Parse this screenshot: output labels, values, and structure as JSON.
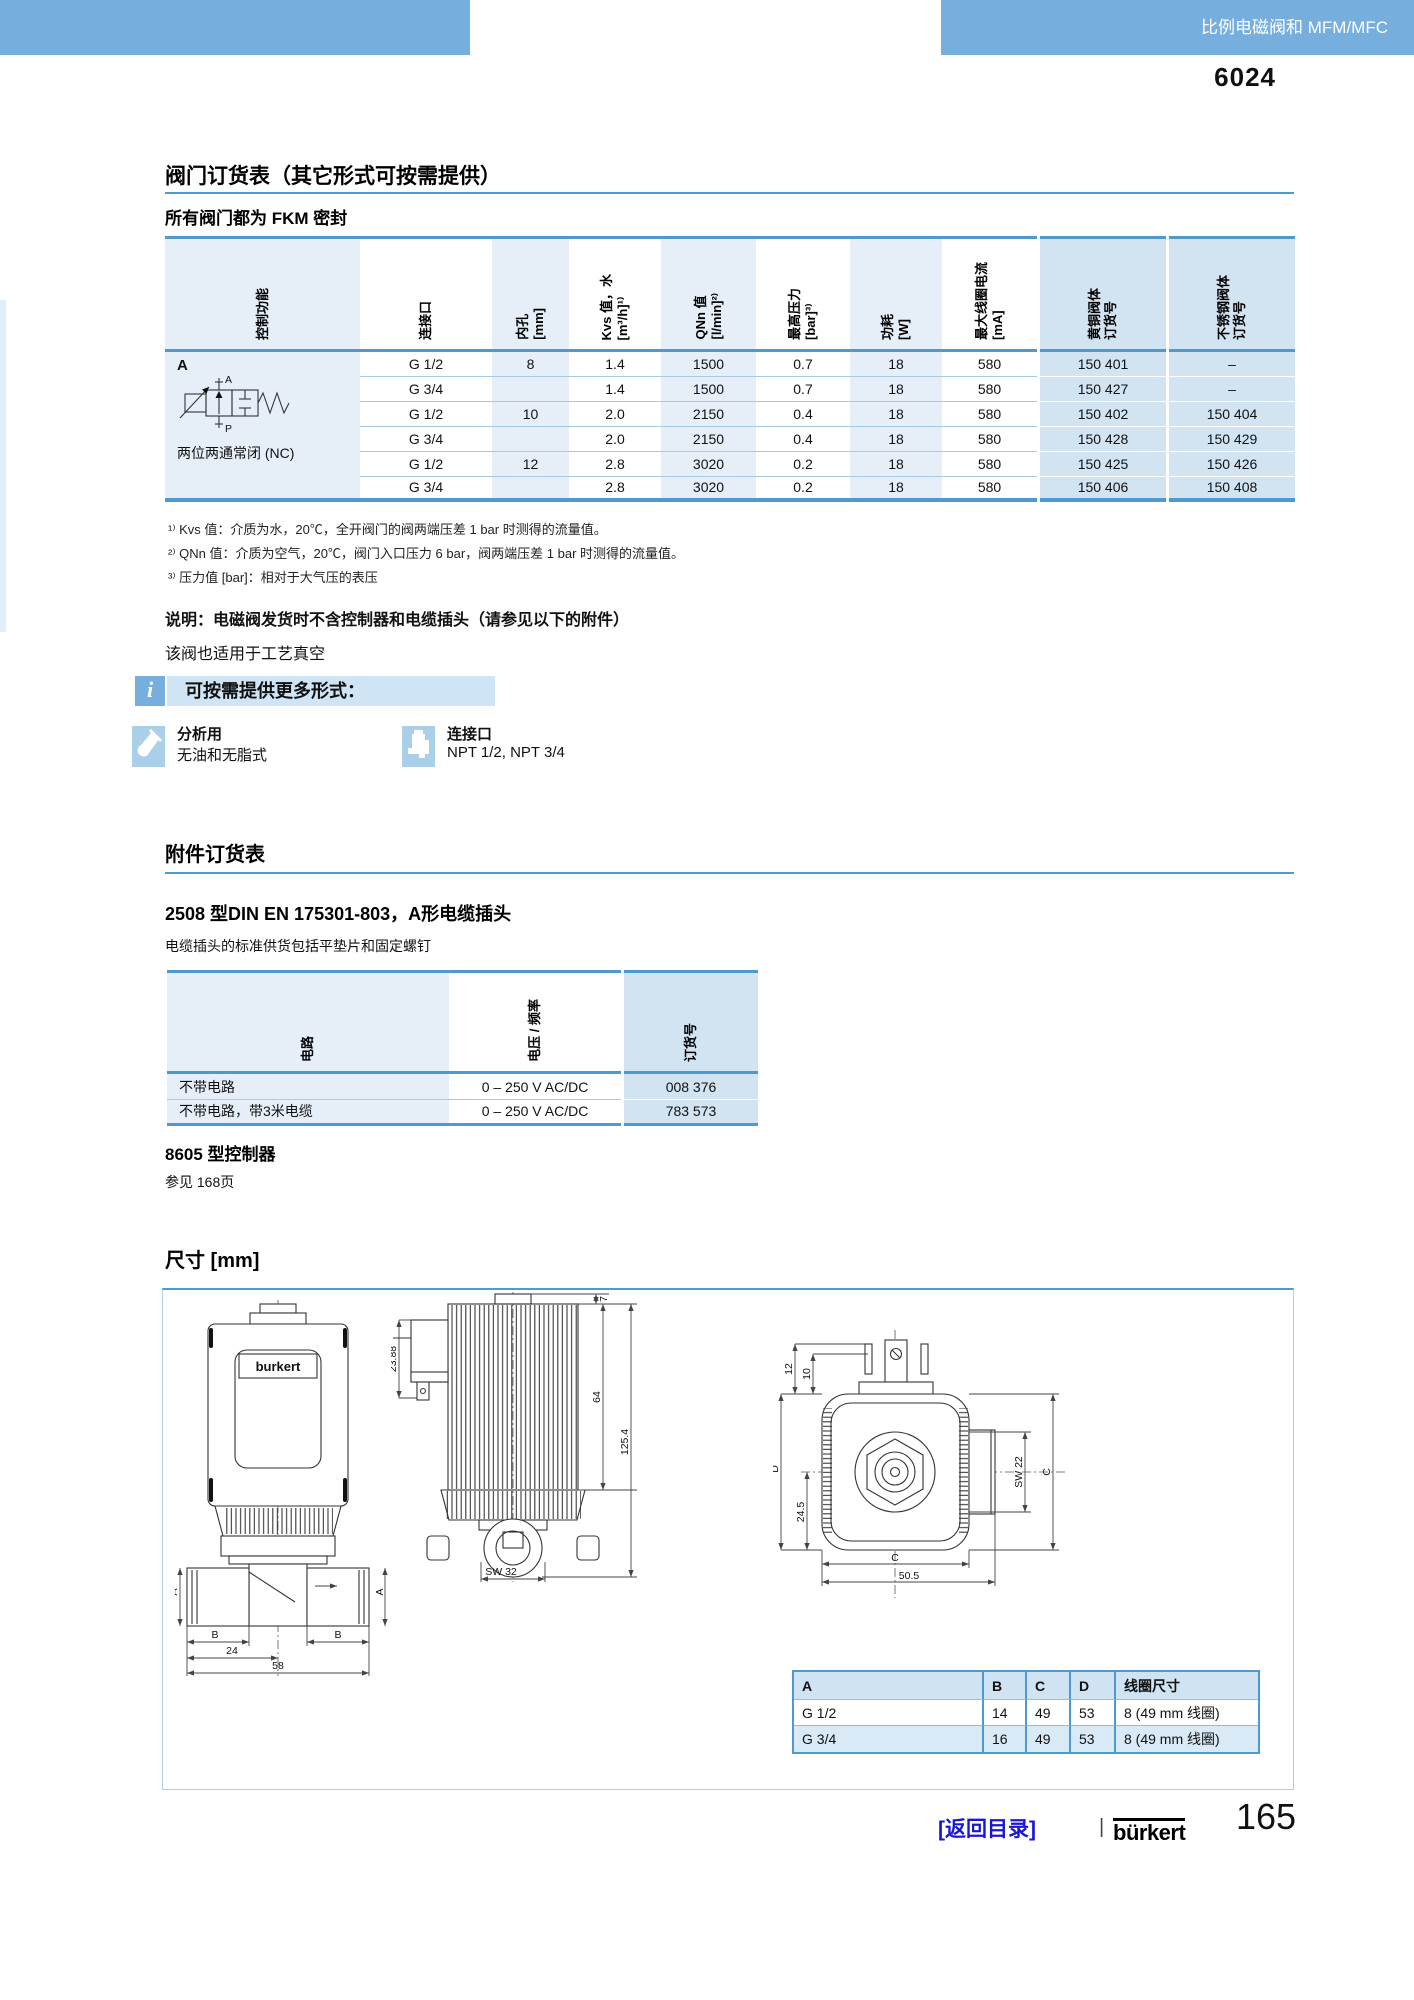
{
  "header": {
    "banner_label": "比例电磁阀和 MFM/MFC",
    "type_number": "6024"
  },
  "valve_section": {
    "title": "阀门订货表（其它形式可按需提供）",
    "subtitle": "所有阀门都为 FKM 密封",
    "table": {
      "headers": [
        "控制功能",
        "连接口",
        "内孔\n[mm]",
        "Kvs 值，水\n[m³/h]¹⁾",
        "QNn 值\n[l/min]²⁾",
        "最高压力\n[bar]³⁾",
        "功耗\n[W]",
        "最大线圈电流\n[mA]",
        "黄铜阀体\n订货号",
        "不锈钢阀体\n订货号"
      ],
      "control": {
        "code": "A",
        "port_top": "A",
        "port_bottom": "P",
        "caption": "两位两通常闭 (NC)"
      },
      "rows": [
        [
          "G 1/2",
          "8",
          "1.4",
          "1500",
          "0.7",
          "18",
          "580",
          "150 401",
          "–"
        ],
        [
          "G 3/4",
          "",
          "1.4",
          "1500",
          "0.7",
          "18",
          "580",
          "150 427",
          "–"
        ],
        [
          "G 1/2",
          "10",
          "2.0",
          "2150",
          "0.4",
          "18",
          "580",
          "150 402",
          "150 404"
        ],
        [
          "G 3/4",
          "",
          "2.0",
          "2150",
          "0.4",
          "18",
          "580",
          "150 428",
          "150 429"
        ],
        [
          "G 1/2",
          "12",
          "2.8",
          "3020",
          "0.2",
          "18",
          "580",
          "150 425",
          "150 426"
        ],
        [
          "G 3/4",
          "",
          "2.8",
          "3020",
          "0.2",
          "18",
          "580",
          "150 406",
          "150 408"
        ]
      ]
    },
    "footnotes": [
      "¹⁾ Kvs 值：介质为水，20℃，全开阀门的阀两端压差 1 bar 时测得的流量值。",
      "²⁾ QNn 值：介质为空气，20℃，阀门入口压力 6 bar，阀两端压差 1 bar 时测得的流量值。",
      "³⁾ 压力值 [bar]：相对于大气压的表压"
    ],
    "note_bold": "说明：电磁阀发货时不含控制器和电缆插头（请参见以下的附件）",
    "note_regular": "该阀也适用于工艺真空",
    "info": {
      "icon_glyph": "i",
      "label": "可按需提供更多形式：",
      "options": [
        {
          "title": "分析用",
          "desc": "无油和无脂式"
        },
        {
          "title": "连接口",
          "desc": "NPT 1/2, NPT 3/4"
        }
      ]
    }
  },
  "accessories_section": {
    "title": "附件订货表",
    "subtitle": "2508 型DIN EN 175301-803，A形电缆插头",
    "desc": "电缆插头的标准供货包括平垫片和固定螺钉",
    "table": {
      "headers": [
        "电路",
        "电压 / 频率",
        "订货号"
      ],
      "rows": [
        [
          "不带电路",
          "0 – 250 V AC/DC",
          "008 376"
        ],
        [
          "不带电路，带3米电缆",
          "0 – 250 V AC/DC",
          "783 573"
        ]
      ]
    },
    "controller_title": "8605 型控制器",
    "controller_ref": "参见 168页"
  },
  "dimensions_section": {
    "title": "尺寸 [mm]",
    "front_view": {
      "brand": "burkert",
      "dims": {
        "a": "A",
        "b": "B",
        "w24": "24",
        "w58": "58"
      }
    },
    "side_view": {
      "dims": {
        "d2388": "23.88",
        "d7": "7",
        "d64": "64",
        "d1254": "125.4",
        "sw32": "SW 32"
      }
    },
    "top_view": {
      "dims": {
        "d12": "12",
        "d10": "10",
        "dD": "D",
        "d245": "24.5",
        "sw22": "SW 22",
        "c_right": "C",
        "c_bottom": "C",
        "d505": "50.5"
      }
    },
    "table": {
      "headers": [
        "A",
        "B",
        "C",
        "D",
        "线圈尺寸"
      ],
      "rows": [
        [
          "G 1/2",
          "14",
          "49",
          "53",
          "8 (49 mm 线圈)"
        ],
        [
          "G 3/4",
          "16",
          "49",
          "53",
          "8 (49 mm 线圈)"
        ]
      ]
    }
  },
  "footer": {
    "back_link": "[返回目录]",
    "separator": "|",
    "brand": "bürkert",
    "page_number": "165"
  },
  "colors": {
    "banner_blue": "#76aede",
    "line_blue": "#4f99d1",
    "light_column": "#e6eff8",
    "order_column": "#d2e4f2",
    "info_bar": "#cfe4f4",
    "icon_blue": "#a9cfe9",
    "link_blue": "#1a16d8"
  }
}
